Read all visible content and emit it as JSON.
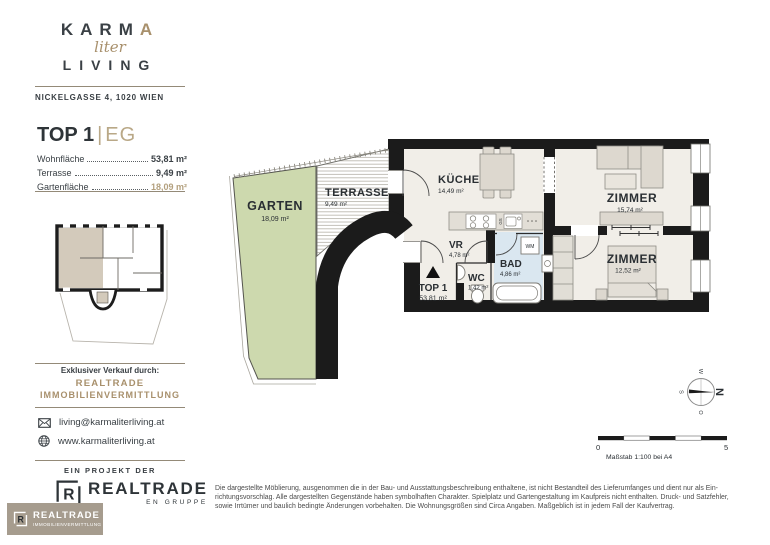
{
  "brand": {
    "wordmark_line1_main": "KARM",
    "wordmark_line1_accent": "A",
    "wordmark_script": "liter",
    "wordmark_line2": "LIVING",
    "address": "NICKELGASSE 4, 1020 WIEN"
  },
  "unit": {
    "title": "TOP 1",
    "separator": "|",
    "stage": "EG",
    "areas": [
      {
        "label": "Wohnfläche",
        "value": "53,81 m²"
      },
      {
        "label": "Terrasse",
        "value": "9,49 m²"
      },
      {
        "label": "Gartenfläche",
        "value": "18,09 m²"
      }
    ]
  },
  "sales": {
    "heading": "Exklusiver Verkauf durch:",
    "company_line1": "REALTRADE",
    "company_line2": "IMMOBILIENVERMITTLUNG",
    "email": "living@karmaliterliving.at",
    "website": "www.karmaliterliving.at"
  },
  "project": {
    "kicker": "EIN PROJEKT DER",
    "logo_letter": "R",
    "logo_text": "REALTRADE",
    "logo_subtext": "EN GRUPPE"
  },
  "badge": {
    "letter": "R",
    "line1": "REALTRADE",
    "line2": "IMMOBILIENVERMITTLUNG"
  },
  "plan": {
    "rooms": [
      {
        "id": "garten",
        "name": "GARTEN",
        "area": "18,09 m²"
      },
      {
        "id": "terrasse",
        "name": "TERRASSE",
        "area": "9,49 m²"
      },
      {
        "id": "kueche",
        "name": "KÜCHE",
        "area": "14,49 m²"
      },
      {
        "id": "vr",
        "name": "VR",
        "area": "4,78 m²"
      },
      {
        "id": "wc",
        "name": "WC",
        "area": "1,42 m²"
      },
      {
        "id": "bad",
        "name": "BAD",
        "area": "4,86 m²"
      },
      {
        "id": "zimmer-1",
        "name": "ZIMMER",
        "area": "15,74 m²"
      },
      {
        "id": "zimmer-2",
        "name": "ZIMMER",
        "area": "12,52 m²"
      }
    ],
    "entrance": {
      "label": "TOP 1",
      "area": "53,81 m²"
    },
    "appliances": {
      "washing_machine": "WM",
      "dishwasher": "GS"
    }
  },
  "compass": {
    "n": "N",
    "o": "O",
    "s": "S",
    "w": "W"
  },
  "scalebar": {
    "start": "0",
    "end": "5",
    "caption": "Maßstab 1:100 bei A4"
  },
  "disclaimer": {
    "line1": "Die dargestellte Möblierung, ausgenommen die in der Bau- und Ausstattungsbeschreibung enthaltene, ist nicht Bestandteil des Lieferumfanges und dient nur als Ein-",
    "line2": "richtungsvorschlag. Alle dargestellten Gegenstände haben symbolhaften Charakter. Spielplatz und Gartengestaltung im Kaufpreis nicht enthalten. Druck- und Satzfehler,",
    "line3": "sowie Irrtümer und baulich bedingte Änderungen vorbehalten. Die Wohnungsgrößen sind Circa Angaben. Maßgeblich ist in jedem Fall der Kaufvertrag."
  },
  "colors": {
    "accent_gold": "#a8906c",
    "accent_gold_light": "#b9a887",
    "wall_black": "#1b1b1b",
    "garden_green": "#cdd9ae",
    "bath_blue": "#dae7f0",
    "floor_cream": "#f1eee8",
    "badge_taupe": "#a69c8e",
    "text_dark": "#2e3438"
  }
}
